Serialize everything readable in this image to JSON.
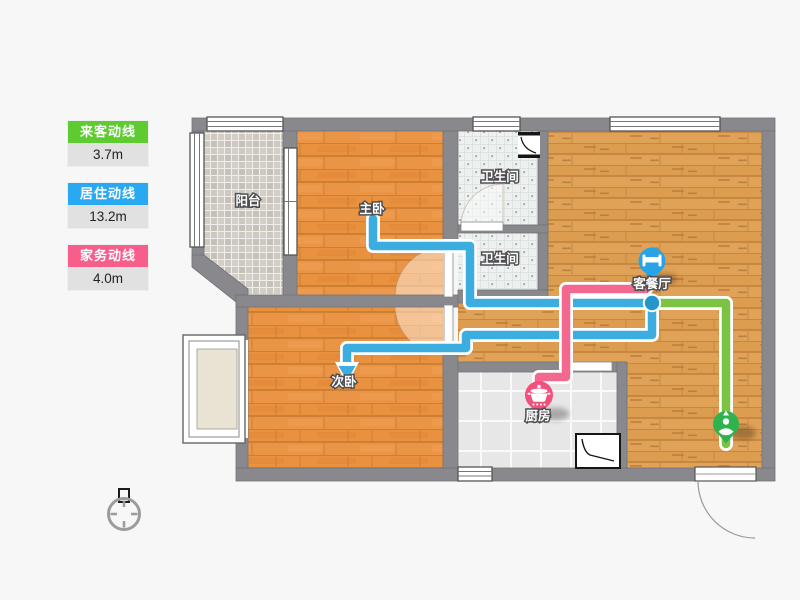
{
  "legend": {
    "items": [
      {
        "label": "来客动线",
        "value": "3.7m",
        "color": "#5dcb31"
      },
      {
        "label": "居住动线",
        "value": "13.2m",
        "color": "#29a9f1"
      },
      {
        "label": "家务动线",
        "value": "4.0m",
        "color": "#f75e8c"
      }
    ]
  },
  "rooms": {
    "balcony": "阳台",
    "master_bedroom": "主卧",
    "bathroom_1": "卫生间",
    "bathroom_2": "卫生间",
    "living_dining": "客餐厅",
    "second_bedroom": "次卧",
    "kitchen": "厨房"
  },
  "icons": {
    "bed_pin": "bed-icon",
    "pot_pin": "cooking-pot-icon",
    "person_pin": "person-icon",
    "compass": "north-compass-icon"
  },
  "colors": {
    "line_blue": "#3badde",
    "line_pink": "#f2688e",
    "line_green": "#7cc344",
    "junction_blue": "#2496cc",
    "pin_blue": "#29a3e8",
    "pin_pink": "#f2517d",
    "pin_green": "#2eb34f",
    "wall_gray": "#89898d"
  }
}
